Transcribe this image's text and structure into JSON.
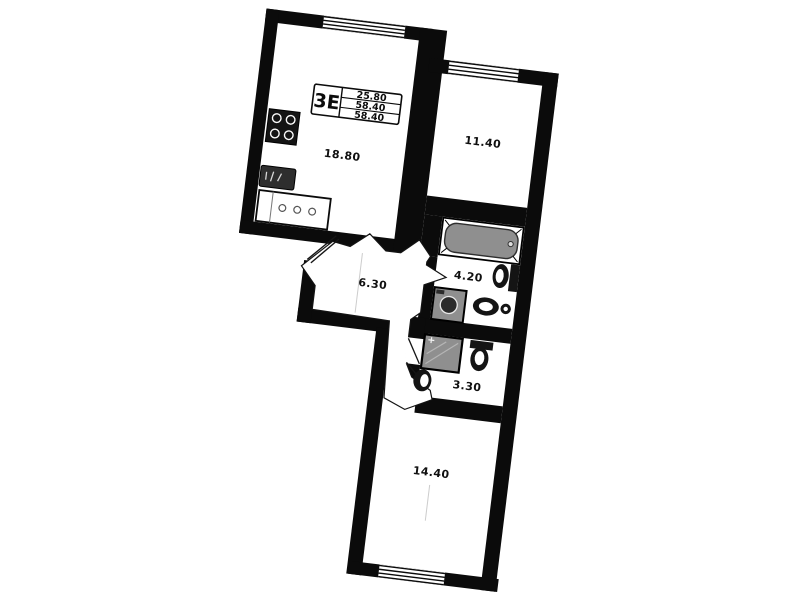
{
  "plan": {
    "unit_stamp": {
      "type_code": "3E",
      "rows": [
        "25.80",
        "58.40",
        "58.40"
      ]
    },
    "rooms": [
      {
        "name": "kitchen-living-room",
        "area_label": "18.80"
      },
      {
        "name": "bedroom-upper",
        "area_label": "11.40"
      },
      {
        "name": "hallway",
        "area_label": "6.30"
      },
      {
        "name": "bathroom",
        "area_label": "4.20"
      },
      {
        "name": "wc-shower-room",
        "area_label": "3.30"
      },
      {
        "name": "bedroom-lower",
        "area_label": "14.40"
      }
    ],
    "icons": [
      "window-symbol",
      "door-swing-symbol",
      "bathtub-icon",
      "toilet-icon",
      "sink-icon",
      "washing-machine-icon",
      "shower-icon",
      "stove-icon",
      "kitchen-counter-icon",
      "gas-box-icon"
    ],
    "colors": {
      "walls": "#0b0b0b",
      "background": "#ffffff",
      "fixture_gray": "#8f8f8f",
      "faint_guide": "#cccccc"
    }
  }
}
